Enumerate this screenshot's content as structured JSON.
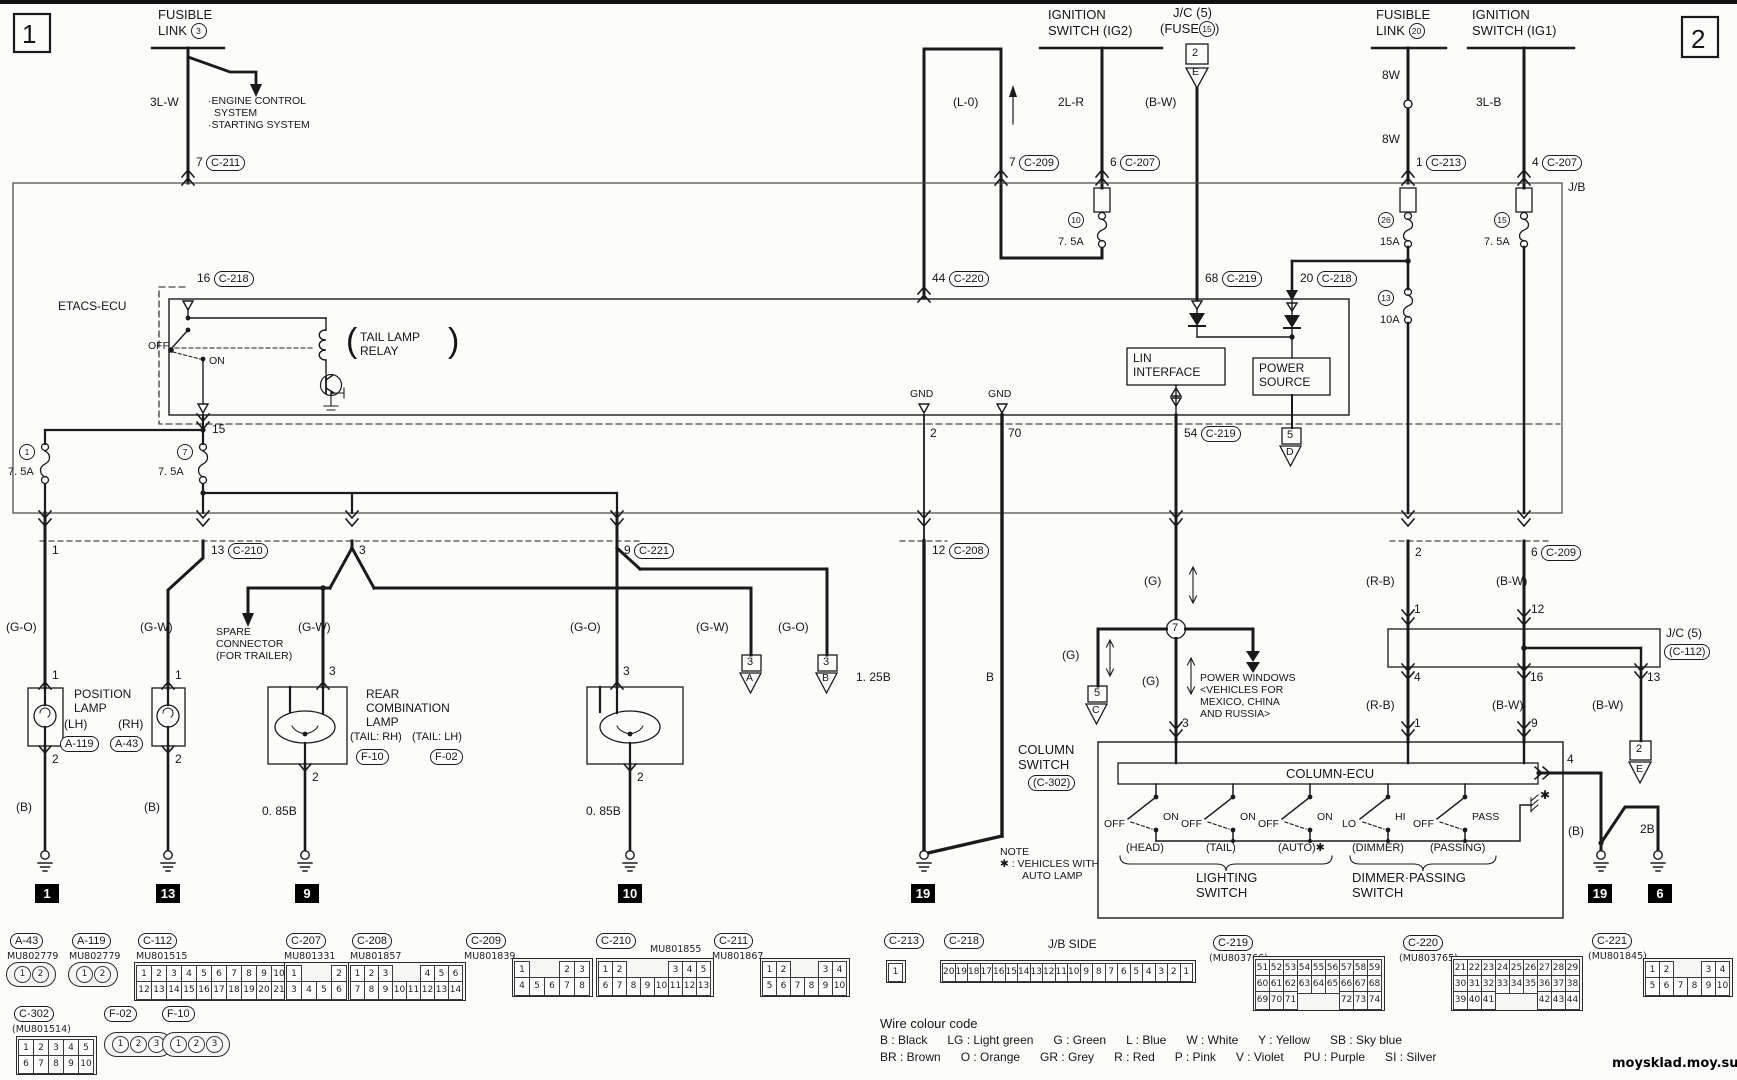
{
  "page_left": "1",
  "page_right": "2",
  "jb_label": "J/B",
  "watermark": "moysklad.moy.su",
  "top": {
    "fl3": {
      "l1": "FUSIBLE",
      "l2": "LINK",
      "num": "3",
      "wire": "3L-W",
      "pin": "7",
      "conn": "C-211",
      "dest": [
        "·ENGINE CONTROL",
        "SYSTEM",
        "·STARTING SYSTEM"
      ]
    },
    "ig2": {
      "l1": "IGNITION",
      "l2": "SWITCH (IG2)",
      "wire": "2L-R",
      "pin": "6",
      "conn": "C-207"
    },
    "jc5_top": {
      "l1": "J/C (5)",
      "l2": "(FUSE",
      "num": "15",
      "l3": ")",
      "ref_num": "2",
      "ref_letter": "E",
      "wire": "(B-W)"
    },
    "l0": {
      "wire": "(L-0)",
      "pin": "7",
      "conn": "C-209"
    },
    "fl20": {
      "l1": "FUSIBLE",
      "l2": "LINK",
      "num": "20",
      "wire1": "8W",
      "wire2": "8W",
      "pin": "1",
      "conn": "C-213"
    },
    "ig1": {
      "l1": "IGNITION",
      "l2": "SWITCH (IG1)",
      "wire": "3L-B",
      "pin": "4",
      "conn": "C-207"
    }
  },
  "fuses": {
    "f1": {
      "num": "1",
      "amp": "7. 5A"
    },
    "f7": {
      "num": "7",
      "amp": "7. 5A"
    },
    "f10": {
      "num": "10",
      "amp": "7. 5A"
    },
    "f26": {
      "num": "26",
      "amp": "15A"
    },
    "f15": {
      "num": "15",
      "amp": "7. 5A"
    },
    "f13": {
      "num": "13",
      "amp": "10A"
    }
  },
  "etacs": {
    "name": "ETACS-ECU",
    "p16": {
      "pin": "16",
      "conn": "C-218"
    },
    "p44": {
      "pin": "44",
      "conn": "C-220"
    },
    "p68": {
      "pin": "68",
      "conn": "C-219"
    },
    "p20": {
      "pin": "20",
      "conn": "C-218"
    },
    "relay": {
      "off": "OFF",
      "on": "ON",
      "paren_l": "(",
      "l1": "TAIL LAMP",
      "l2": "RELAY",
      "paren_r": ")"
    },
    "lin": {
      "l1": "LIN",
      "l2": "INTERFACE"
    },
    "power": {
      "l1": "POWER",
      "l2": "SOURCE"
    },
    "p15": "15",
    "gnd1": "GND",
    "gnd2": "GND",
    "p2": "2",
    "p70": "70",
    "p54": {
      "pin": "54",
      "conn": "C-219"
    },
    "ref5d": {
      "num": "5",
      "letter": "D"
    }
  },
  "mid": {
    "p1": "1",
    "p13": {
      "pin": "13",
      "conn": "C-210"
    },
    "p3": "3",
    "p9": {
      "pin": "9",
      "conn": "C-221"
    },
    "p12": {
      "pin": "12",
      "conn": "C-208"
    },
    "w_go1": "(G-O)",
    "w_gw1": "(G-W)",
    "w_gw2": "(G-W)",
    "w_go2": "(G-O)",
    "w_gw3": "(G-W)",
    "w_go3": "(G-O)",
    "spare": [
      "SPARE",
      "CONNECTOR",
      "(FOR TRAILER)"
    ],
    "ref3a": {
      "num": "3",
      "letter": "A"
    },
    "ref3b": {
      "num": "3",
      "letter": "B"
    },
    "w_125b": "1. 25B",
    "w_b": "B"
  },
  "lamps": {
    "position": {
      "l1": "POSITION",
      "l2": "LAMP",
      "lh": "(LH)",
      "rh": "(RH)",
      "lh_conn": "A-119",
      "rh_conn": "A-43",
      "lh_p1": "1",
      "lh_p2": "2",
      "rh_p1": "1",
      "rh_p2": "2",
      "lh_wire": "(B)",
      "rh_wire": "(B)"
    },
    "rear": {
      "l1": "REAR",
      "l2": "COMBINATION",
      "l3": "LAMP",
      "rh": "(TAIL: RH)",
      "lh": "(TAIL: LH)",
      "rh_conn": "F-10",
      "lh_conn": "F-02",
      "rh_p3": "3",
      "rh_p2": "2",
      "lh_p3": "3",
      "lh_p2": "2",
      "rh_wire": "0. 85B",
      "lh_wire": "0. 85B"
    }
  },
  "right": {
    "p2": "2",
    "p6": {
      "pin": "6",
      "conn": "C-209"
    },
    "jc5": {
      "l1": "J/C (5)",
      "l2": "(C-112)"
    },
    "a_top": "1",
    "a_bot": "4",
    "a_in": "1",
    "b_top": "12",
    "b_bot": "16",
    "b_in": "9",
    "c_bot": "13",
    "w_rb1": "(R-B)",
    "w_rb2": "(R-B)",
    "w_bw1": "(B-W)",
    "w_bw2": "(B-W)",
    "w_bw3": "(B-W)",
    "ref2e": {
      "num": "2",
      "letter": "E"
    },
    "p4_out": "4",
    "w_b": "(B)",
    "w_2b": "2B",
    "star": "✱"
  },
  "column": {
    "g1": "(G)",
    "g2": "(G)",
    "g3": "(G)",
    "junction": "7",
    "p3": "3",
    "ref5c": {
      "num": "5",
      "letter": "C"
    },
    "power_windows": [
      "POWER WINDOWS",
      "<VEHICLES FOR",
      "MEXICO, CHINA",
      "AND RUSSIA>"
    ],
    "l1": "COLUMN",
    "l2": "SWITCH",
    "conn": "(C-302)",
    "ecu": "COLUMN-ECU",
    "sw": [
      {
        "a": "OFF",
        "b": "ON",
        "name": "(HEAD)"
      },
      {
        "a": "OFF",
        "b": "ON",
        "name": "(TAIL)"
      },
      {
        "a": "OFF",
        "b": "ON",
        "name": "(AUTO)✱"
      },
      {
        "a": "LO",
        "b": "HI",
        "name": "(DIMMER)"
      },
      {
        "a": "OFF",
        "b": "PASS",
        "name": "(PASSING)"
      }
    ],
    "lighting": [
      "LIGHTING",
      "SWITCH"
    ],
    "dimmer": [
      "DIMMER·PASSING",
      "SWITCH"
    ]
  },
  "grounds": {
    "g1": "1",
    "g13": "13",
    "g9": "9",
    "g10": "10",
    "g19a": "19",
    "g19b": "19",
    "g6": "6"
  },
  "note": [
    "NOTE",
    "✱ : VEHICLES WITH",
    "AUTO LAMP"
  ],
  "wire_code": {
    "title": "Wire colour code",
    "line1": "B : Black      LG : Light green      G : Green      L : Blue      W : White      Y : Yellow      SB : Sky blue",
    "line2": "BR : Brown      O : Orange      GR : Grey      R : Red      P : Pink      V : Violet      PU : Purple      SI : Silver"
  },
  "connectors": {
    "jb_side": "J/B SIDE",
    "a43": {
      "id": "A-43",
      "mu": "MU802779",
      "rows": [
        [
          "1",
          "2"
        ]
      ]
    },
    "a119": {
      "id": "A-119",
      "mu": "MU802779",
      "rows": [
        [
          "1",
          "2"
        ]
      ]
    },
    "c112": {
      "id": "C-112",
      "mu": "MU801515",
      "rows": [
        [
          "1",
          "2",
          "3",
          "4",
          "5",
          "6",
          "7",
          "8",
          "9",
          "10",
          "11"
        ],
        [
          "12",
          "13",
          "14",
          "15",
          "16",
          "17",
          "18",
          "19",
          "20",
          "21",
          "22"
        ]
      ]
    },
    "c302": {
      "id": "C-302",
      "mu": "(MU801514)",
      "rows": [
        [
          "1",
          "2",
          "3",
          "4",
          "5"
        ],
        [
          "6",
          "7",
          "8",
          "9",
          "10"
        ]
      ]
    },
    "f02": {
      "id": "F-02",
      "rows": [
        [
          "1",
          "2",
          "3"
        ]
      ]
    },
    "f10": {
      "id": "F-10",
      "rows": [
        [
          "1",
          "2",
          "3"
        ]
      ]
    },
    "c207": {
      "id": "C-207",
      "mu": "MU801331",
      "rows": [
        [
          "1",
          "",
          "",
          "2"
        ],
        [
          "3",
          "4",
          "5",
          "6"
        ]
      ]
    },
    "c208": {
      "id": "C-208",
      "mu": "MU801857",
      "rows": [
        [
          "1",
          "2",
          "3",
          "",
          "",
          "4",
          "5",
          "6"
        ],
        [
          "7",
          "8",
          "9",
          "10",
          "11",
          "12",
          "13",
          "14"
        ]
      ]
    },
    "c209": {
      "id": "C-209",
      "mu": "MU801839",
      "rows": [
        [
          "1",
          "",
          "",
          "2",
          "3"
        ],
        [
          "4",
          "5",
          "6",
          "7",
          "8"
        ]
      ]
    },
    "c210": {
      "id": "C-210",
      "mu": "MU801855",
      "rows": [
        [
          "1",
          "2",
          "",
          "",
          "",
          "3",
          "4",
          "5"
        ],
        [
          "6",
          "7",
          "8",
          "9",
          "10",
          "11",
          "12",
          "13"
        ]
      ]
    },
    "c211": {
      "id": "C-211",
      "mu": "MU801867",
      "rows": [
        [
          "1",
          "2",
          "",
          "",
          "3",
          "4"
        ],
        [
          "5",
          "6",
          "7",
          "8",
          "9",
          "10"
        ]
      ]
    },
    "c213": {
      "id": "C-213",
      "rows": [
        [
          "1"
        ]
      ]
    },
    "c218": {
      "id": "C-218",
      "rows": [
        [
          "20",
          "19",
          "18",
          "17",
          "16",
          "15",
          "14",
          "13",
          "12",
          "11",
          "10",
          "9",
          "8",
          "7",
          "6",
          "5",
          "4",
          "3",
          "2",
          "1"
        ]
      ]
    },
    "c219": {
      "id": "C-219",
      "mu": "(MU803766)",
      "rows": [
        [
          "51",
          "52",
          "53",
          "54",
          "55",
          "56",
          "57",
          "58",
          "59"
        ],
        [
          "60",
          "61",
          "62",
          "63",
          "64",
          "65",
          "66",
          "67",
          "68"
        ],
        [
          "69",
          "70",
          "71",
          "",
          "",
          "",
          "72",
          "73",
          "74"
        ]
      ]
    },
    "c220": {
      "id": "C-220",
      "mu": "(MU803765)",
      "rows": [
        [
          "21",
          "22",
          "23",
          "24",
          "25",
          "26",
          "27",
          "28",
          "29"
        ],
        [
          "30",
          "31",
          "32",
          "33",
          "34",
          "35",
          "36",
          "37",
          "38"
        ],
        [
          "39",
          "40",
          "41",
          "",
          "",
          "",
          "42",
          "43",
          "44"
        ]
      ]
    },
    "c221": {
      "id": "C-221",
      "mu": "(MU801845)",
      "rows": [
        [
          "1",
          "2",
          "",
          "",
          "3",
          "4"
        ],
        [
          "5",
          "6",
          "7",
          "8",
          "9",
          "10"
        ]
      ]
    }
  }
}
